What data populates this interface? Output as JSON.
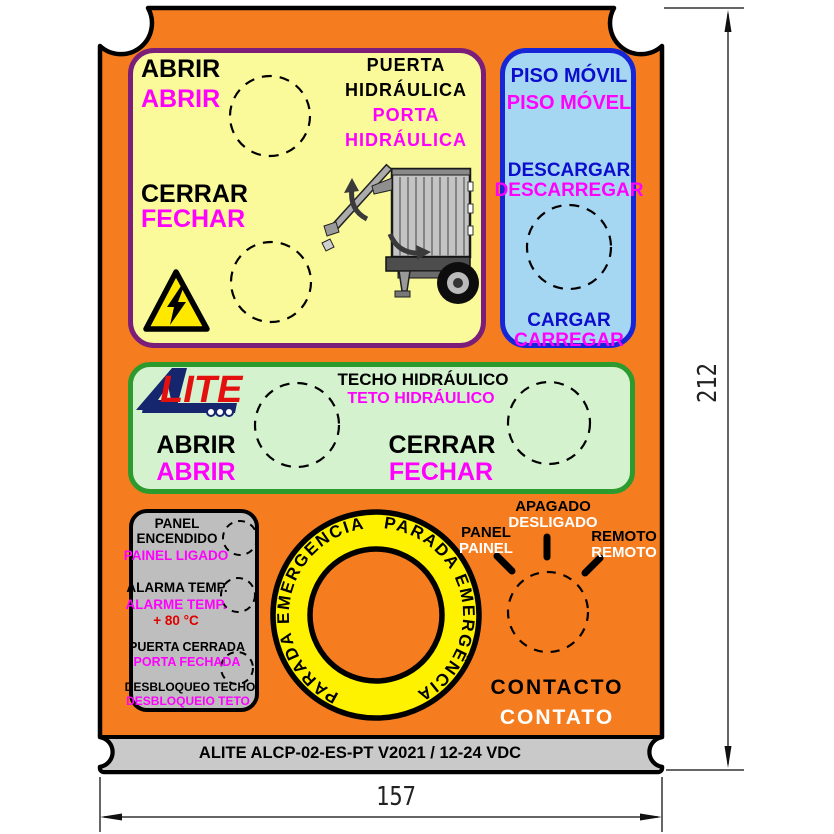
{
  "colors": {
    "panel_orange": "#F57D1F",
    "footer_gray": "#C9C9C9",
    "yellow_section_bg": "#FAFA9B",
    "blue_section_bg": "#A6D7F2",
    "green_section_bg": "#D4F2CE",
    "indicator_box_bg": "#BEBEBE",
    "es_text": "#000000",
    "pt_text_magenta": "#FF00FF",
    "pt_text_white": "#FFFFFF",
    "blue_text": "#0D0DCD",
    "alarm_red": "#E00000",
    "estop_ring_yellow": "#FFF200"
  },
  "yellow_section": {
    "open_es": "ABRIR",
    "open_pt": "ABRIR",
    "close_es": "CERRAR",
    "close_pt": "FECHAR",
    "title_es_line1": "PUERTA",
    "title_es_line2": "HIDRÁULICA",
    "title_pt_line1": "PORTA",
    "title_pt_line2": "HIDRÁULICA"
  },
  "blue_section": {
    "title_es": "PISO MÓVIL",
    "title_pt": "PISO MÓVEL",
    "unload_es": "DESCARGAR",
    "unload_pt": "DESCARREGAR",
    "load_es": "CARGAR",
    "load_pt": "CARREGAR"
  },
  "green_section": {
    "logo_text": "LITE",
    "title_es": "TECHO HIDRÁULICO",
    "title_pt": "TETO HIDRÁULICO",
    "open_es": "ABRIR",
    "open_pt": "ABRIR",
    "close_es": "CERRAR",
    "close_pt": "FECHAR"
  },
  "indicator_box": {
    "panel_on_es_line1": "PANEL",
    "panel_on_es_line2": "ENCENDIDO",
    "panel_on_pt": "PAINEL LIGADO",
    "temp_alarm_es": "ALARMA TEMP.",
    "temp_alarm_pt": "ALARME TEMP.",
    "temp_value": "+ 80 °C",
    "door_closed_es": "PUERTA CERRADA",
    "door_closed_pt": "PORTA FECHADA",
    "roof_unlock_es": "DESBLOQUEO TECHO",
    "roof_unlock_pt": "DESBLOQUEIO TETO"
  },
  "estop": {
    "arc_es": "PARADA EMERGENCIA",
    "arc_pt": "PARADA EMERGÊNCIA"
  },
  "selector": {
    "left_es": "PANEL",
    "left_pt": "PAINEL",
    "center_es": "APAGADO",
    "center_pt": "DESLIGADO",
    "right_es": "REMOTO",
    "right_pt": "REMOTO",
    "title_es": "CONTACTO",
    "title_pt": "CONTATO"
  },
  "footer": {
    "model": "ALITE ALCP-02-ES-PT V2021 / 12-24 VDC"
  },
  "dimensions": {
    "height": "212",
    "width": "157"
  }
}
